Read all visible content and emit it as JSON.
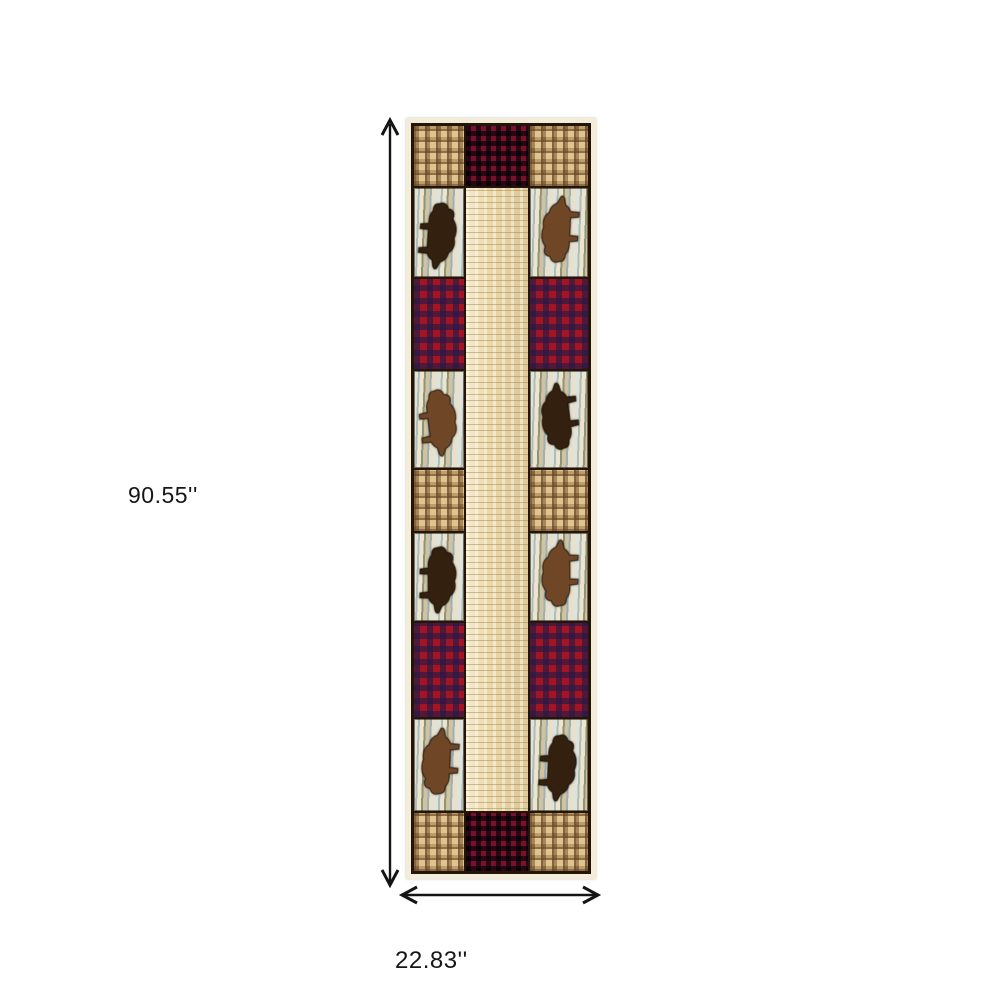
{
  "page": {
    "background": "#ffffff",
    "annotation_color": "#141414"
  },
  "dimensions": {
    "height_label": "90.55''",
    "width_label": "22.83''"
  },
  "rug": {
    "description_name": "lodge-bear-patchwork-runner-rug",
    "columns": [
      50,
      62,
      58
    ],
    "rows": [
      {
        "type": "triple",
        "h": 60
      },
      {
        "type": "bear",
        "h": 89,
        "left": {
          "color": "dark",
          "rot": 96
        },
        "right": {
          "color": "brown",
          "rot": -85
        }
      },
      {
        "type": "plaid",
        "side": "red",
        "h": 90
      },
      {
        "type": "bear",
        "h": 97,
        "left": {
          "color": "brown",
          "rot": 85
        },
        "right": {
          "color": "dark",
          "rot": -95
        }
      },
      {
        "type": "plaid",
        "side": "tan",
        "h": 61
      },
      {
        "type": "bear",
        "h": 88,
        "left": {
          "color": "dark",
          "rot": 92
        },
        "right": {
          "color": "brown",
          "rot": -88
        }
      },
      {
        "type": "plaid",
        "side": "red",
        "h": 94
      },
      {
        "type": "bear",
        "h": 92,
        "left": {
          "color": "brown",
          "rot": -85
        },
        "right": {
          "color": "dark",
          "rot": 95
        }
      },
      {
        "type": "triple",
        "h": 58
      }
    ],
    "colors": {
      "tan_plaid_base": "#c49e66",
      "tan_plaid_dark": "rgba(104,72,38,0.55)",
      "red_plaid_base": "#a31523",
      "red_check_base": "#77122a",
      "red_check_navy": "rgba(38,30,80,0.78)",
      "beige_base": "#ead9ac",
      "beige_line": "rgba(166,120,56,0.45)",
      "birch_light": "#dfe3da",
      "birch_blue": "#aebcba",
      "birch_olive": "#8d9478",
      "bear_dark": "#33200f",
      "bear_brown": "#6f4726",
      "seam": "#241509",
      "outer_edge": "#f3ecd9"
    }
  }
}
